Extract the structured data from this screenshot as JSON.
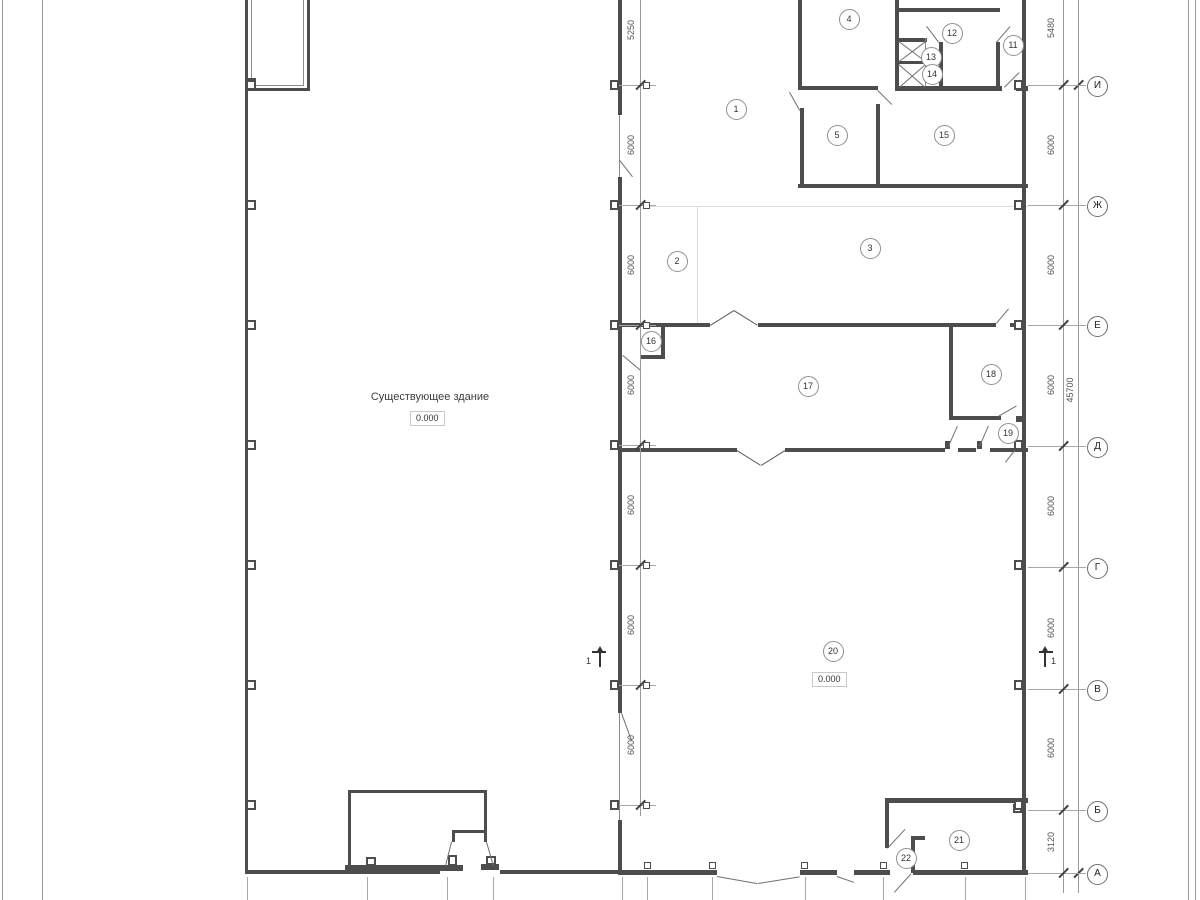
{
  "drawing": {
    "building_label": "Существующее здание",
    "elevation_left": "0.000",
    "elevation_right": "0.000",
    "section_mark_left": "1",
    "section_mark_right": "1",
    "axes_right": [
      {
        "label": "И",
        "y": 85
      },
      {
        "label": "Ж",
        "y": 205
      },
      {
        "label": "Е",
        "y": 325
      },
      {
        "label": "Д",
        "y": 446
      },
      {
        "label": "Г",
        "y": 567
      },
      {
        "label": "В",
        "y": 689
      },
      {
        "label": "Б",
        "y": 810
      },
      {
        "label": "А",
        "y": 873
      }
    ],
    "dims_right": [
      {
        "text": "5480",
        "y": 28
      },
      {
        "text": "6000",
        "y": 145
      },
      {
        "text": "6000",
        "y": 265
      },
      {
        "text": "6000",
        "y": 385
      },
      {
        "text": "6000",
        "y": 506
      },
      {
        "text": "6000",
        "y": 628
      },
      {
        "text": "6000",
        "y": 748
      },
      {
        "text": "3120",
        "y": 842
      }
    ],
    "dim_total_right": {
      "text": "45700",
      "y": 390
    },
    "dims_left": [
      {
        "text": "5250",
        "y": 30
      },
      {
        "text": "6000",
        "y": 145
      },
      {
        "text": "6000",
        "y": 265
      },
      {
        "text": "6000",
        "y": 385
      },
      {
        "text": "6000",
        "y": 505
      },
      {
        "text": "6000",
        "y": 625
      },
      {
        "text": "6000",
        "y": 745
      }
    ],
    "left_ticks_y": [
      85,
      205,
      325,
      445,
      565,
      685,
      805
    ],
    "rooms": [
      {
        "n": "1",
        "x": 735,
        "y": 108
      },
      {
        "n": "2",
        "x": 676,
        "y": 260
      },
      {
        "n": "3",
        "x": 869,
        "y": 247
      },
      {
        "n": "4",
        "x": 848,
        "y": 18
      },
      {
        "n": "5",
        "x": 836,
        "y": 134
      },
      {
        "n": "11",
        "x": 1012,
        "y": 44
      },
      {
        "n": "12",
        "x": 951,
        "y": 32
      },
      {
        "n": "13",
        "x": 930,
        "y": 56
      },
      {
        "n": "14",
        "x": 931,
        "y": 73
      },
      {
        "n": "15",
        "x": 943,
        "y": 134
      },
      {
        "n": "16",
        "x": 650,
        "y": 340
      },
      {
        "n": "17",
        "x": 807,
        "y": 385
      },
      {
        "n": "18",
        "x": 990,
        "y": 373
      },
      {
        "n": "19",
        "x": 1007,
        "y": 432
      },
      {
        "n": "20",
        "x": 832,
        "y": 650
      },
      {
        "n": "21",
        "x": 958,
        "y": 839
      },
      {
        "n": "22",
        "x": 905,
        "y": 857
      }
    ]
  }
}
